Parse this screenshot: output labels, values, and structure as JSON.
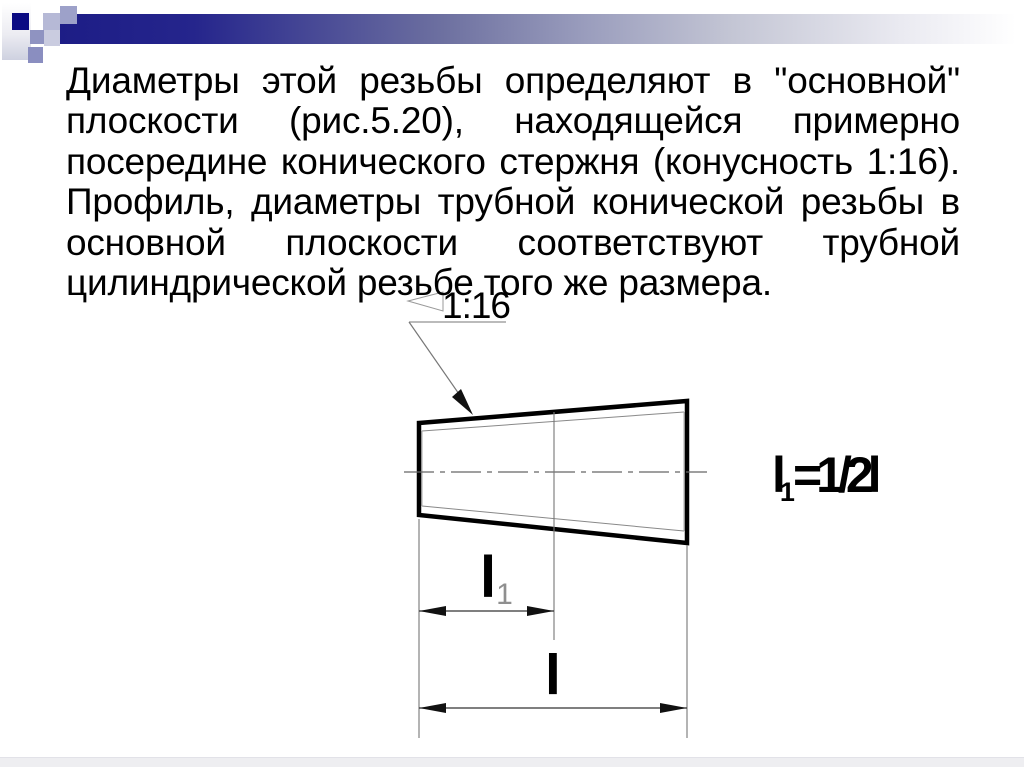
{
  "slide": {
    "paragraph": {
      "lines": [
        "Диаметры этой резьбы определяют в \"основной\"",
        "плоскости (рис.5.20), находящейся примерно",
        "посередине конического стержня (конусность 1:16).",
        "Профиль, диаметры трубной конической резьбы в",
        "основной плоскости соответствуют трубной",
        "цилиндрической резьбе того же размера."
      ]
    },
    "figure": {
      "taper_label": "1:16",
      "basic_plane_dim": {
        "main": "l",
        "sub": "1"
      },
      "length_dim_label": "l",
      "formula": {
        "main": "l",
        "sub": "1",
        "rest": "=1/2l"
      }
    },
    "colors": {
      "accent_navy": "#1d1d86",
      "bar_mid_lavender": "#9a9dbd",
      "decor_periwinkle": "#8a8ec0",
      "text": "#000000",
      "drawing_thin_line": "#777777",
      "drawing_outline": "#000000",
      "footer_strip": "#eeeef1"
    }
  }
}
